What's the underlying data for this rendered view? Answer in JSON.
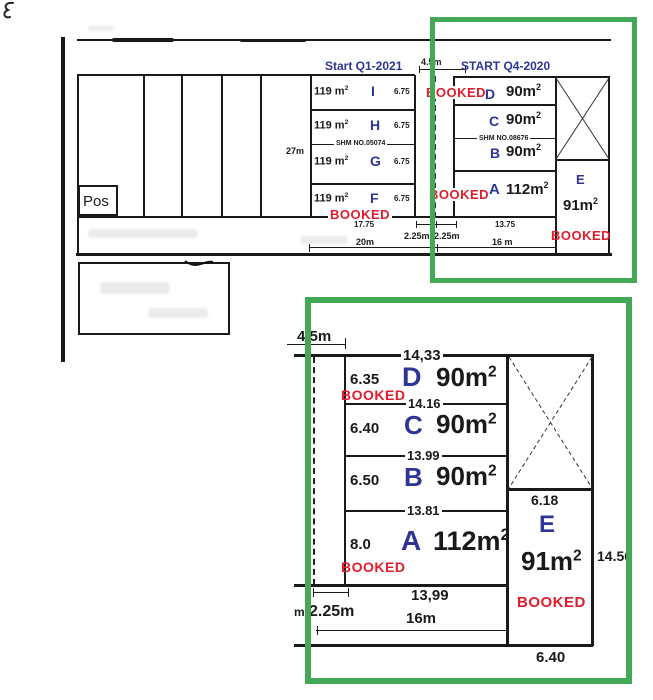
{
  "colors": {
    "blue": "#2e3596",
    "red": "#e01d2c",
    "green": "#43a957",
    "line": "#1a1a1a"
  },
  "overview": {
    "start_q1": "Start Q1-2021",
    "start_q4": "START Q4-2020",
    "gap": "4.5m",
    "pos": "Pos",
    "depth": "27m",
    "shm_mid": "SHM NO.05074",
    "shm_right": "SHM NO.08676",
    "mid_units": [
      {
        "area": "119 m",
        "sup": "2",
        "letter": "I",
        "depth": "6.75"
      },
      {
        "area": "119 m",
        "sup": "2",
        "letter": "H",
        "depth": "6.75"
      },
      {
        "area": "119 m",
        "sup": "2",
        "letter": "G",
        "depth": "6.75"
      },
      {
        "area": "119 m",
        "sup": "2",
        "letter": "F",
        "depth": "6.75"
      }
    ],
    "right_units": [
      {
        "letter": "D",
        "area": "90m",
        "sup": "2"
      },
      {
        "letter": "C",
        "area": "90m",
        "sup": "2"
      },
      {
        "letter": "B",
        "area": "90m",
        "sup": "2"
      },
      {
        "letter": "A",
        "area": "112m",
        "sup": "2"
      }
    ],
    "unit_e": {
      "letter": "E",
      "area": "91m",
      "sup": "2"
    },
    "booked_f": "BOOKED",
    "booked_d": "BOOKED",
    "booked_a": "BOOKED",
    "booked_e": "BOOKED",
    "dims": {
      "f_width": "17.75",
      "a_width": "13.75",
      "gap_left": "2.25m",
      "gap_right": "2.25m",
      "total_left": "20m",
      "total_right": "16 m"
    }
  },
  "detail": {
    "gap": "4.5m",
    "top_width": "14,33",
    "rows": [
      {
        "depth": "6.35",
        "letter": "D",
        "area": "90m",
        "sup": "2",
        "booked": "BOOKED",
        "bottom_width": "14.16"
      },
      {
        "depth": "6.40",
        "letter": "C",
        "area": "90m",
        "sup": "2",
        "bottom_width": "13.99"
      },
      {
        "depth": "6.50",
        "letter": "B",
        "area": "90m",
        "sup": "2",
        "bottom_width": "13.81"
      },
      {
        "depth": "8.0",
        "letter": "A",
        "area": "112m",
        "sup": "2",
        "booked": "BOOKED",
        "bottom_width": "13,99"
      }
    ],
    "bottom_width": "16m",
    "gap_dim": "2.25m",
    "stray": "m",
    "e_top": "6.18",
    "e": {
      "letter": "E",
      "area": "91m",
      "sup": "2",
      "booked": "BOOKED"
    },
    "e_right": "14.56",
    "e_bottom": "6.40"
  }
}
